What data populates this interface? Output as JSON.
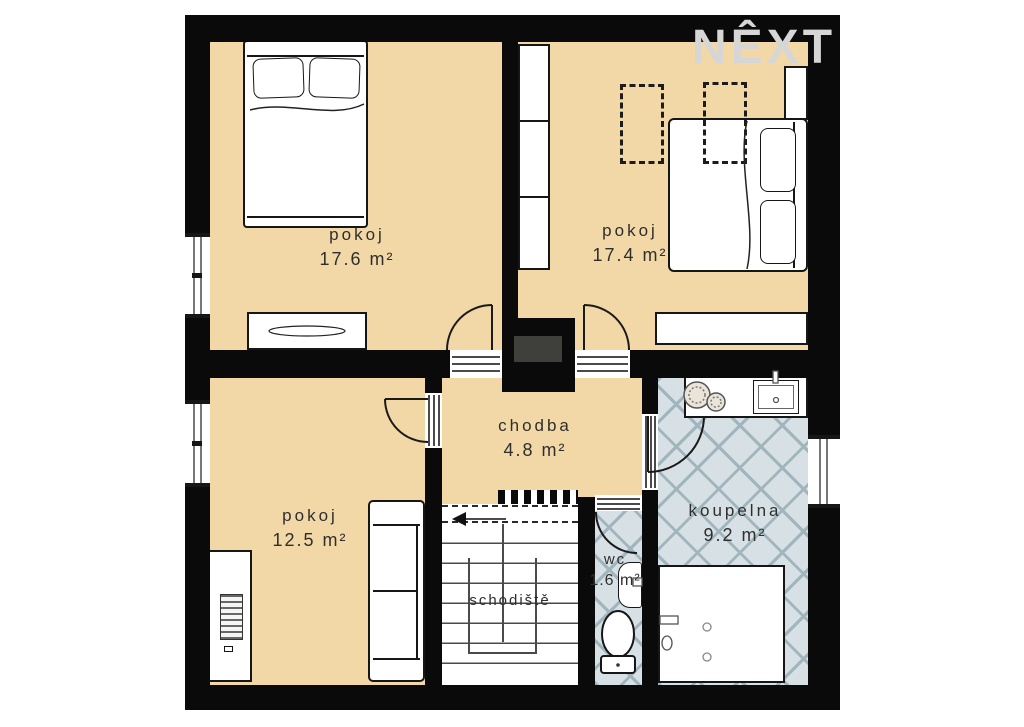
{
  "watermark": {
    "text": "NÊXT"
  },
  "rooms": {
    "pokoj_tl": {
      "name": "pokoj",
      "area": "17.6 m²"
    },
    "pokoj_tr": {
      "name": "pokoj",
      "area": "17.4 m²"
    },
    "pokoj_bl": {
      "name": "pokoj",
      "area": "12.5 m²"
    },
    "chodba": {
      "name": "chodba",
      "area": "4.8 m²"
    },
    "koupelna": {
      "name": "koupelna",
      "area": "9.2 m²"
    },
    "wc": {
      "name": "wc",
      "area": "1.6 m²"
    },
    "schodiste": {
      "name": "schodiště"
    }
  },
  "colors": {
    "wall": "#0a0a0a",
    "floor": "#f2d8a6",
    "tile_bg": "#d7e1e5",
    "tile_line": "#a0b5bc",
    "chimney": "#3f3f3c",
    "watermark": "#d6d6d6",
    "label_text": "#2e2e2e"
  }
}
